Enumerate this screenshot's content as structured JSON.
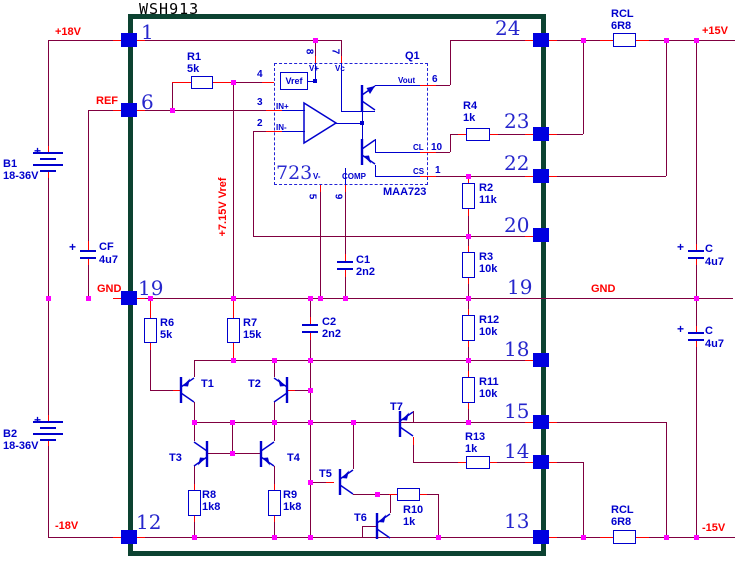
{
  "title": "WSH913",
  "power_labels": {
    "plus18": "+18V",
    "ref": "REF",
    "gnd_left": "GND",
    "minus18": "-18V",
    "plus15": "+15V",
    "gnd_right": "GND",
    "minus15": "-15V",
    "vref_rail": "+7.15V Vref"
  },
  "batteries": {
    "b1": {
      "ref": "B1",
      "value": "18-36V",
      "polarity": "+"
    },
    "b2": {
      "ref": "B2",
      "value": "18-36V",
      "polarity": "+"
    }
  },
  "capacitors": {
    "cf": {
      "ref": "CF",
      "value": "4u7",
      "polarity": "+"
    },
    "c1": {
      "ref": "C1",
      "value": "2n2"
    },
    "c2": {
      "ref": "C2",
      "value": "2n2"
    },
    "c_top_right": {
      "ref": "C",
      "value": "4u7",
      "polarity": "+"
    },
    "c_bottom_right": {
      "ref": "C",
      "value": "4u7",
      "polarity": "+"
    }
  },
  "resistors": {
    "r1": {
      "ref": "R1",
      "value": "5k"
    },
    "r2": {
      "ref": "R2",
      "value": "11k"
    },
    "r3": {
      "ref": "R3",
      "value": "10k"
    },
    "r4": {
      "ref": "R4",
      "value": "1k"
    },
    "r6": {
      "ref": "R6",
      "value": "5k"
    },
    "r7": {
      "ref": "R7",
      "value": "15k"
    },
    "r8": {
      "ref": "R8",
      "value": "1k8"
    },
    "r9": {
      "ref": "R9",
      "value": "1k8"
    },
    "r10": {
      "ref": "R10",
      "value": "1k"
    },
    "r11": {
      "ref": "R11",
      "value": "10k"
    },
    "r12": {
      "ref": "R12",
      "value": "10k"
    },
    "r13": {
      "ref": "R13",
      "value": "1k"
    },
    "rcl_top": {
      "ref": "RCL",
      "value": "6R8"
    },
    "rcl_bottom": {
      "ref": "RCL",
      "value": "6R8"
    }
  },
  "transistors": {
    "t1": "T1",
    "t2": "T2",
    "t3": "T3",
    "t4": "T4",
    "t5": "T5",
    "t6": "T6",
    "t7": "T7"
  },
  "ic": {
    "designator": "Q1",
    "part": "MAA723",
    "label": "723",
    "vref_block": "Vref",
    "pin_names": {
      "v_plus": "V+",
      "vc": "Vc",
      "vout": "Vout",
      "cl": "CL",
      "cs": "CS",
      "v_minus": "V-",
      "comp": "COMP",
      "in_plus": "IN+",
      "in_minus": "IN-"
    },
    "pin_numbers": {
      "n8": "8",
      "n7": "7",
      "n4": "4",
      "n3": "3",
      "n2": "2",
      "n6": "6",
      "n10": "10",
      "n1": "1",
      "n5": "5",
      "n9": "9"
    }
  },
  "package_pins": {
    "left": {
      "p1": "1",
      "p6": "6",
      "p19": "19",
      "p12": "12"
    },
    "right": {
      "p24": "24",
      "p23": "23",
      "p22": "22",
      "p20": "20",
      "p19": "19",
      "p18": "18",
      "p15": "15",
      "p14": "14",
      "p13": "13"
    }
  }
}
